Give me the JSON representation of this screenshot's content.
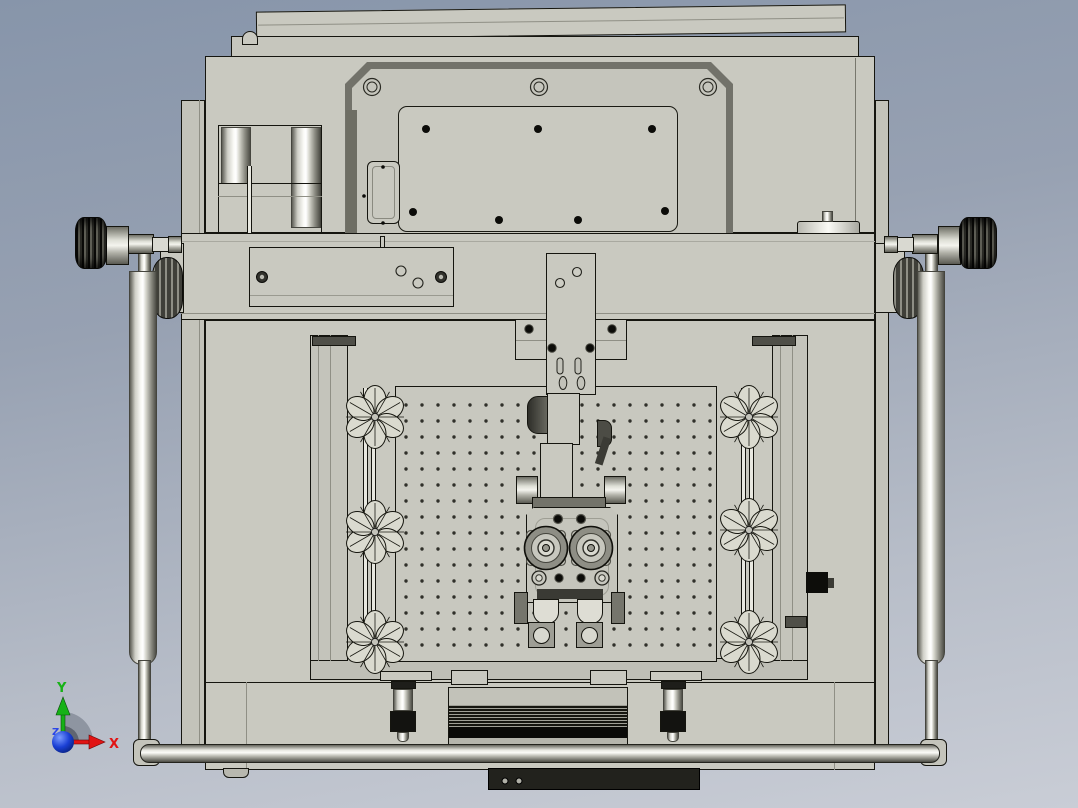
{
  "viewport": {
    "width": 1078,
    "height": 808,
    "description": "CAD front orthographic view of automated machine assembly"
  },
  "colors": {
    "background_top": "#8b99ad",
    "background_bottom": "#c6cbd4",
    "body": "#c9c9c0",
    "outline": "#15150f",
    "recess_frame": "#72726a",
    "metal_highlight": "#fbfbf7",
    "knob_dark": "#2b2b26",
    "vent_black": "#0a0a08"
  },
  "triad": {
    "x_label": "X",
    "y_label": "Y",
    "z_label": "Z",
    "x_color": "#e11414",
    "y_color": "#16b216",
    "z_color": "#2b46e8"
  },
  "perforated_plate": {
    "cols": 20,
    "rows": 16,
    "spacing": 16,
    "origin_x": 405,
    "origin_y": 404,
    "hole_color": "#30302a"
  },
  "star_knobs": {
    "lobes": 6,
    "radius": 32,
    "positions": [
      [
        375,
        417
      ],
      [
        375,
        532
      ],
      [
        375,
        642
      ],
      [
        749,
        417
      ],
      [
        749,
        530
      ],
      [
        749,
        642
      ]
    ]
  },
  "top_panel": {
    "screws": [
      [
        372,
        87
      ],
      [
        539,
        87
      ],
      [
        708,
        87
      ]
    ],
    "plate_holes": [
      [
        426,
        129
      ],
      [
        538,
        129
      ],
      [
        652,
        129
      ],
      [
        413,
        212
      ],
      [
        499,
        220
      ],
      [
        578,
        220
      ],
      [
        665,
        211
      ]
    ],
    "small_dots": [
      [
        383,
        167
      ],
      [
        383,
        223
      ],
      [
        364,
        196
      ]
    ]
  },
  "beam_bracket": {
    "screws": [
      [
        262,
        277
      ],
      [
        441,
        277
      ]
    ],
    "holes": [
      [
        401,
        271
      ],
      [
        418,
        283
      ]
    ]
  },
  "z_slide": {
    "ring_holes": [
      [
        577,
        272
      ],
      [
        560,
        283
      ]
    ],
    "dots": [
      [
        552,
        348
      ],
      [
        590,
        348
      ]
    ],
    "slots": [
      [
        560,
        358
      ],
      [
        578,
        358
      ]
    ],
    "oval_holes": [
      [
        563,
        383
      ],
      [
        581,
        383
      ]
    ]
  },
  "wing_dots": [
    [
      529,
      329
    ],
    [
      612,
      329
    ]
  ],
  "tool_head": {
    "rollers": [
      [
        546,
        548
      ],
      [
        591,
        548
      ]
    ],
    "roller_radius": 21.5,
    "top_dots": [
      [
        558,
        519
      ],
      [
        581,
        519
      ]
    ],
    "bottom_dots": [
      [
        559,
        578
      ],
      [
        581,
        578
      ]
    ],
    "bottom_rings": [
      [
        539,
        578
      ],
      [
        602,
        578
      ]
    ]
  },
  "base_plate_bolts": [
    [
      505,
      781
    ],
    [
      519,
      781
    ]
  ]
}
